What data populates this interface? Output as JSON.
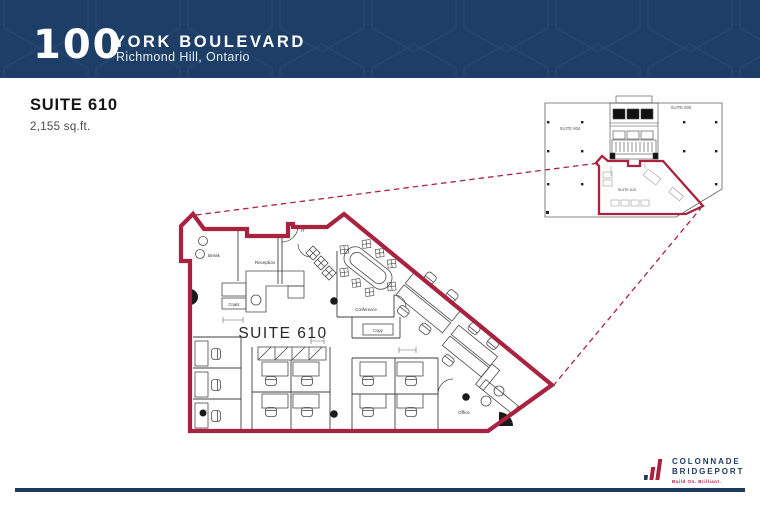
{
  "header": {
    "building_number": "100",
    "building_name": "YORK BOULEVARD",
    "location": "Richmond Hill, Ontario"
  },
  "suite_info": {
    "title": "SUITE 610",
    "area": "2,155 sq.ft."
  },
  "floor_plan": {
    "suite_label": "SUITE 610",
    "rooms": {
      "break": "Break",
      "reception": "Reception",
      "coats": "Coats",
      "it": "IT",
      "conference": "Conference",
      "copy": "Copy",
      "office": "Office"
    }
  },
  "key_plan": {
    "suite_600": "SUITE 600",
    "suite_604": "SUITE 604",
    "suite_610": "SUITE 610"
  },
  "logo": {
    "name_line1": "COLONNADE",
    "name_line2": "BRIDGEPORT",
    "tagline": "Build On. Brilliant."
  },
  "colors": {
    "accent_red": "#a92240",
    "navy": "#1d3e66"
  }
}
